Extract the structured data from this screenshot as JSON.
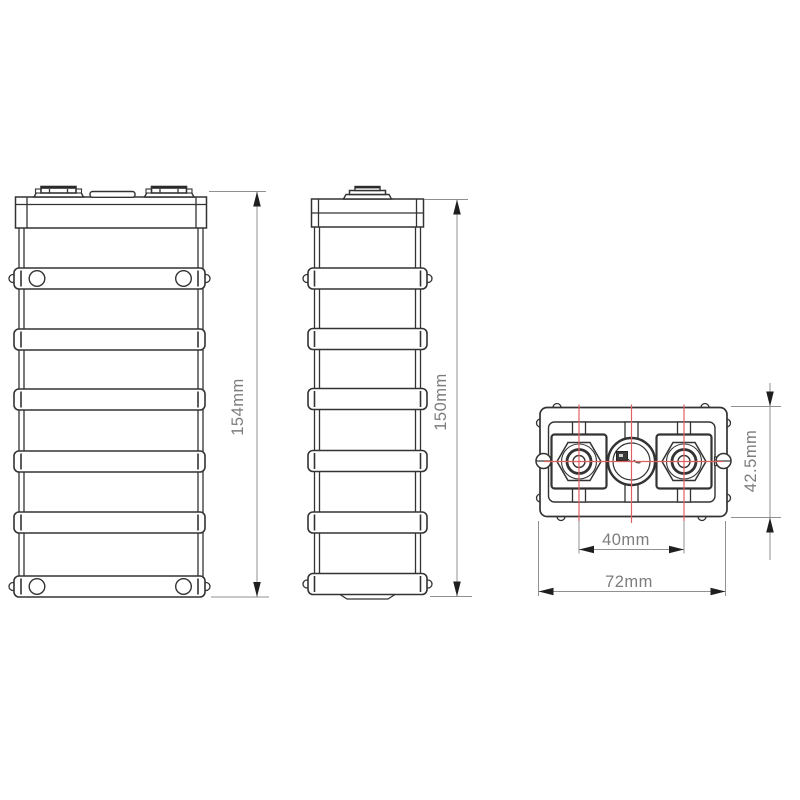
{
  "drawing": {
    "type": "battery-cell-technical-drawing",
    "dimensions": {
      "front_height": "154mm",
      "side_height": "150mm",
      "top_thickness": "42.5mm",
      "terminal_pitch": "40mm",
      "overall_width": "72mm"
    },
    "colors": {
      "outline": "#333333",
      "dimension_line": "#909090",
      "dimension_text": "#7d7d7d",
      "centerline_red": "#e06060",
      "arrow_fill": "#1f1f1f",
      "background": "#ffffff"
    }
  }
}
